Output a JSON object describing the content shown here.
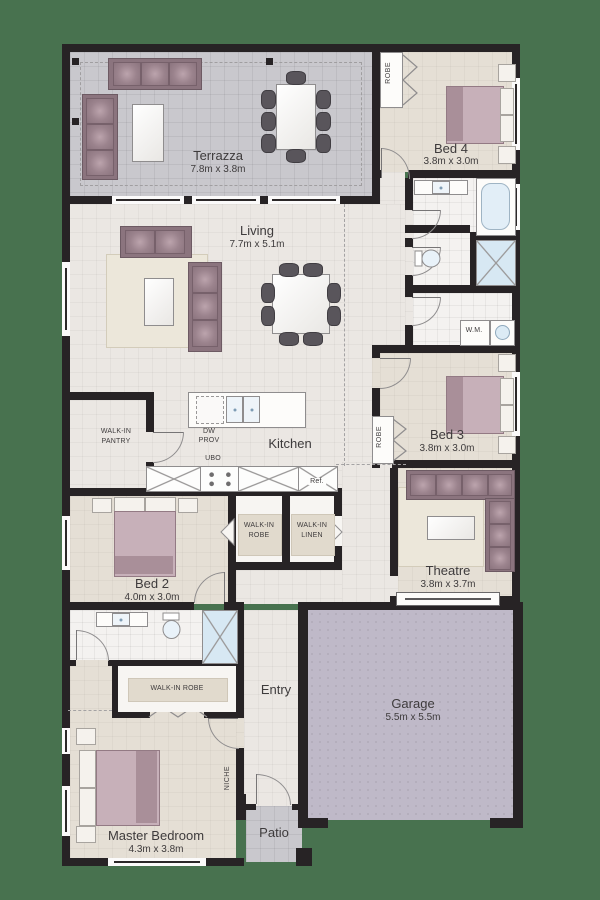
{
  "rooms": {
    "terrazza": {
      "name": "Terrazza",
      "dims": "7.8m x 3.8m"
    },
    "bed4": {
      "name": "Bed 4",
      "dims": "3.8m x 3.0m"
    },
    "living": {
      "name": "Living",
      "dims": "7.7m x 5.1m"
    },
    "bed3": {
      "name": "Bed 3",
      "dims": "3.8m x 3.0m"
    },
    "kitchen": {
      "name": "Kitchen"
    },
    "bed2": {
      "name": "Bed 2",
      "dims": "4.0m x 3.0m"
    },
    "theatre": {
      "name": "Theatre",
      "dims": "3.8m x 3.7m"
    },
    "entry": {
      "name": "Entry"
    },
    "garage": {
      "name": "Garage",
      "dims": "5.5m x 5.5m"
    },
    "master": {
      "name": "Master Bedroom",
      "dims": "4.3m x 3.8m"
    },
    "patio": {
      "name": "Patio"
    }
  },
  "closets": {
    "robe_bed4": "ROBE",
    "robe_bed3": "ROBE",
    "pantry_line1": "WALK-IN",
    "pantry_line2": "PANTRY",
    "robe_hall_line1": "WALK-IN",
    "robe_hall_line2": "ROBE",
    "linen_line1": "WALK-IN",
    "linen_line2": "LINEN",
    "master_robe": "WALK-IN ROBE",
    "niche": "NICHE"
  },
  "kitchen_fixtures": {
    "ubo": "UBO",
    "dw_line1": "DW",
    "dw_line2": "PROV",
    "fridge": "Ref."
  },
  "laundry": {
    "wm": "W.M."
  },
  "colors": {
    "background_grass": "#48724F",
    "walls": "#272325",
    "terrazza_floor": "#c9c8cd",
    "interior_floor": "#ebe7e3",
    "bedroom_floor": "#e5dfd5",
    "garage_floor": "#bfb9c8",
    "sofa_mauve": "#8b747e",
    "bed_mauve": "#c7b0b9",
    "water_blue": "#d7e8f3"
  }
}
